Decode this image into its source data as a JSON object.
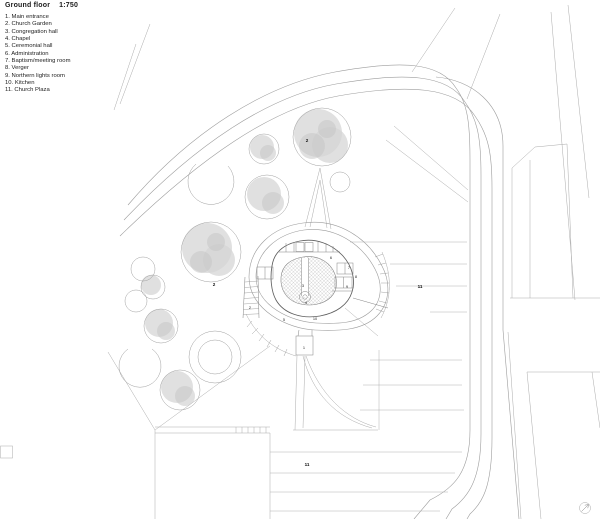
{
  "header": {
    "title": "Ground floor",
    "scale": "1:750"
  },
  "legend": {
    "items": [
      "1. Main entrance",
      "2. Church Garden",
      "3. Congregation hall",
      "4. Chapel",
      "5. Ceremonial hall",
      "6. Administration",
      "7. Baptism/meeting room",
      "8. Verger",
      "9. Northern lights room",
      "10. Kitchen",
      "11. Church Plaza"
    ]
  },
  "plan": {
    "room_labels": [
      "1",
      "2",
      "3",
      "4",
      "5",
      "6",
      "7",
      "8",
      "9",
      "10"
    ],
    "area_labels": {
      "garden_top": "2",
      "garden_west": "2",
      "plaza_east": "11",
      "plaza_south": "11"
    },
    "icons": {
      "north_arrow": "north-arrow-icon",
      "tree": "tree-icon"
    },
    "colors": {
      "site_line": "#9c9c9c",
      "building_line": "#5f5f5f",
      "tree_fill": "#d6d6d6",
      "hatch_line": "#c2c2c2",
      "label_text": "#2a2a2a",
      "background": "#ffffff"
    }
  }
}
